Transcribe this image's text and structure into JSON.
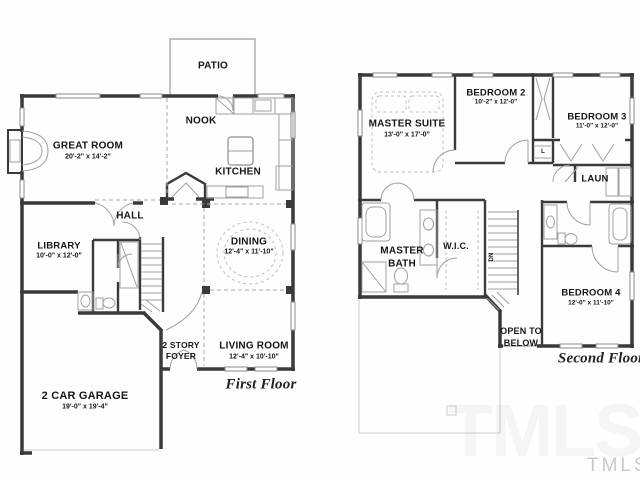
{
  "first_floor": {
    "title": "First Floor",
    "patio": "PATIO",
    "nook": "NOOK",
    "kitchen": "KITCHEN",
    "hall": "HALL",
    "great_room": {
      "name": "GREAT ROOM",
      "dims": "20'-2\" x 14'-2\""
    },
    "library": {
      "name": "LIBRARY",
      "dims": "10'-0\" x 12'-0\""
    },
    "dining": {
      "name": "DINING",
      "dims": "12'-4\" x 11'-10\""
    },
    "living_room": {
      "name": "LIVING ROOM",
      "dims": "12'-4\" x 10'-10\""
    },
    "garage": {
      "name": "2 CAR GARAGE",
      "dims": "19'-0\" x 19'-4\""
    },
    "foyer": {
      "line1": "2 STORY",
      "line2": "FOYER"
    }
  },
  "second_floor": {
    "title": "Second Floor",
    "master_suite": {
      "name": "MASTER SUITE",
      "dims": "13'-0\" x 17'-0\""
    },
    "bedroom_2": {
      "name": "BEDROOM 2",
      "dims": "10'-2\" x 12'-0\""
    },
    "bedroom_3": {
      "name": "BEDROOM 3",
      "dims": "11'-0\" x 12'-0\""
    },
    "bedroom_4": {
      "name": "BEDROOM 4",
      "dims": "12'-0\" x 11'-10\""
    },
    "master_bath": {
      "line1": "MASTER",
      "line2": "BATH"
    },
    "wic": "W.I.C.",
    "laundry": "LAUN",
    "linen_closet": "L",
    "stairs_direction": "DN",
    "open_to_below": {
      "line1": "OPEN TO",
      "line2": "BELOW"
    }
  },
  "watermark": {
    "small": "TMLS",
    "large": "TMLS"
  },
  "colors": {
    "wall": "#3a3a3a",
    "thin_line": "#9f9f9f",
    "watermark": "#c9c9c9"
  }
}
